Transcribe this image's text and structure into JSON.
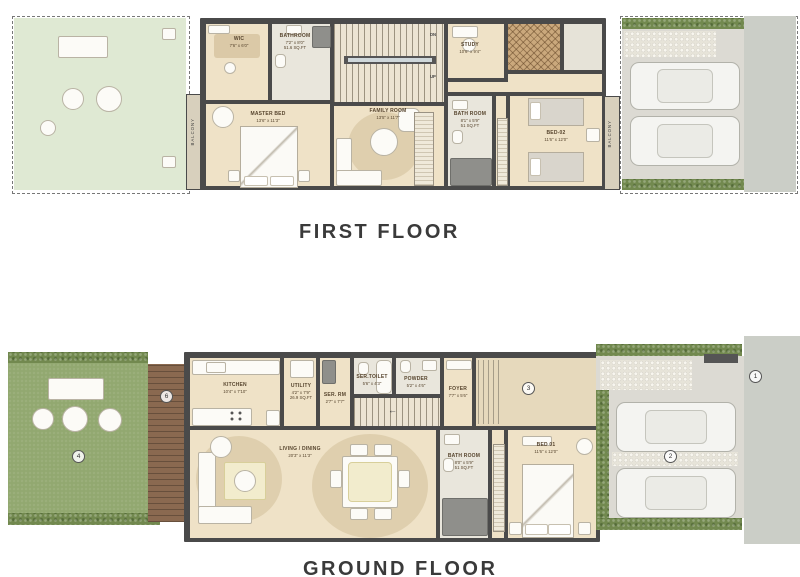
{
  "floors": {
    "first": {
      "title": "FIRST FLOOR",
      "balcony": "BALCONY",
      "stairs": {
        "dn": "DN",
        "up": "UP"
      },
      "rooms": {
        "wic": {
          "name": "WIC",
          "dims": "7'6\" x 6'0\""
        },
        "bathroom": {
          "name": "BATHROOM",
          "dims": "7'2\" x 8'0\"",
          "area": "51.6 SQ.FT"
        },
        "master": {
          "name": "MASTER BED",
          "dims": "13'6\" x 11'3\""
        },
        "family": {
          "name": "FAMILY ROOM",
          "dims": "13'5\" x 11'7\""
        },
        "study": {
          "name": "STUDY",
          "dims": "10'6\" x 9'4\""
        },
        "bath": {
          "name": "BATH ROOM",
          "dims": "8'1\" x 5'9\"",
          "area": "51 SQ.FT"
        },
        "bed2": {
          "name": "BED-02",
          "dims": "11'6\" x 12'0\""
        }
      }
    },
    "ground": {
      "title": "GROUND FLOOR",
      "stairs": {
        "arrow": "←"
      },
      "rooms": {
        "kitchen": {
          "name": "KITCHEN",
          "dims": "10'4\" x 7'10\""
        },
        "utility": {
          "name": "UTILITY",
          "dims": "4'2\" x 7'9\"",
          "area": "26.9 SQ.FT"
        },
        "ser_rm": {
          "name": "SER. RM",
          "dims": "2'7\" x 7'7\""
        },
        "ser_toilet": {
          "name": "SER.TOILET",
          "dims": "5'6\" x 4'3\""
        },
        "powder": {
          "name": "POWDER",
          "dims": "5'2\" x 4'6\""
        },
        "foyer": {
          "name": "FOYER",
          "dims": "7'7\" x 5'6\""
        },
        "living": {
          "name": "LIVING / DINING",
          "dims": "20'3\" x 11'3\""
        },
        "bath": {
          "name": "BATH ROOM",
          "dims": "8'0\" x 5'9\"",
          "area": "51 SQ.FT"
        },
        "bed1": {
          "name": "BED 01",
          "dims": "11'6\" x 12'0\""
        }
      },
      "markers": {
        "road": "1",
        "driveway": "2",
        "entry": "3",
        "garden": "4",
        "deck": "6"
      }
    }
  },
  "colors": {
    "wall": "#4a4a4a",
    "floor_cream": "#efe2c7",
    "floor_tile": "#e9e6dc",
    "lawn_green": "#92a870",
    "terrace_green": "#dfe9d3",
    "hedge_green": "#72894f",
    "deck_brown": "#8a6950",
    "driveway_gray": "#dcdad3",
    "title_text": "#3a3a3a"
  }
}
